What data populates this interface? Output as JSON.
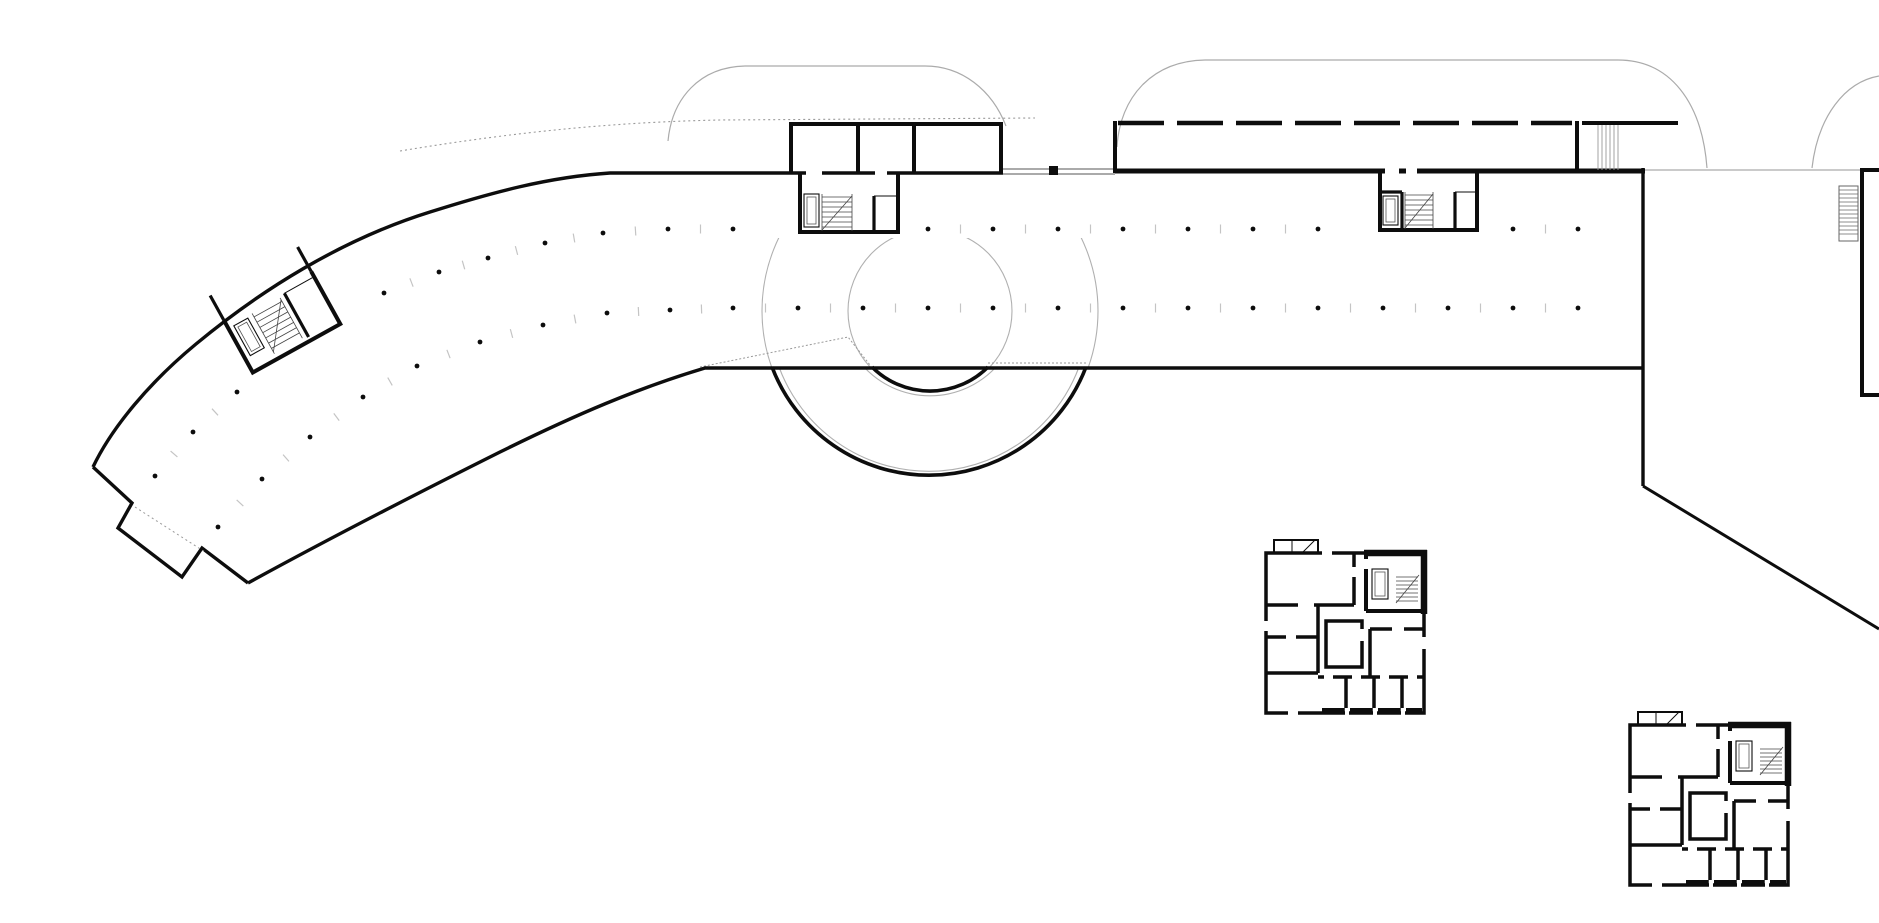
{
  "meta": {
    "drawing": "architectural-site-floor-plan",
    "description": "Line drawing: long curved slab building with parking columns, circular ramp, roof-canopy outlines, three stair cores and two detached square housing units",
    "background": "#ffffff",
    "ink": "#0d0d0d",
    "light_line": "#a6a6a6",
    "dotted_line": "#9a9a9a",
    "tick_color": "#c4c4c4"
  },
  "elements": [
    {
      "name": "curved-slab-building"
    },
    {
      "name": "left-stair-core"
    },
    {
      "name": "top-pavilion-block"
    },
    {
      "name": "pavilion-stair-core"
    },
    {
      "name": "dashed-roof-building"
    },
    {
      "name": "right-stair-core"
    },
    {
      "name": "circular-ramp"
    },
    {
      "name": "roof-canopy-outlines"
    },
    {
      "name": "far-right-room-with-ladder"
    },
    {
      "name": "site-boundary-diagonal"
    },
    {
      "name": "housing-unit-a"
    },
    {
      "name": "housing-unit-b"
    }
  ],
  "diagram": {
    "columns": {
      "dot_radius": 2.4,
      "tick_len": 9,
      "max_gap_for_tick": 80,
      "upper_row": [
        [
          1578,
          229
        ],
        [
          1513,
          229
        ],
        [
          1318,
          229
        ],
        [
          1253,
          229
        ],
        [
          1188,
          229
        ],
        [
          1123,
          229
        ],
        [
          1058,
          229
        ],
        [
          993,
          229
        ],
        [
          928,
          229
        ],
        [
          733,
          229
        ],
        [
          668,
          229
        ],
        [
          603,
          233
        ],
        [
          545,
          243
        ],
        [
          488,
          258
        ],
        [
          439,
          272
        ],
        [
          384,
          293
        ],
        [
          237,
          392
        ],
        [
          193,
          432
        ],
        [
          155,
          476
        ]
      ],
      "lower_row": [
        [
          1578,
          308
        ],
        [
          1513,
          308
        ],
        [
          1448,
          308
        ],
        [
          1383,
          308
        ],
        [
          1318,
          308
        ],
        [
          1253,
          308
        ],
        [
          1188,
          308
        ],
        [
          1123,
          308
        ],
        [
          1058,
          308
        ],
        [
          993,
          308
        ],
        [
          928,
          308
        ],
        [
          863,
          308
        ],
        [
          798,
          308
        ],
        [
          733,
          308
        ],
        [
          670,
          310
        ],
        [
          607,
          313
        ],
        [
          543,
          325
        ],
        [
          480,
          342
        ],
        [
          417,
          366
        ],
        [
          363,
          397
        ],
        [
          310,
          437
        ],
        [
          262,
          479
        ],
        [
          218,
          527
        ]
      ]
    },
    "ramp": {
      "cx": 930,
      "cy": 311,
      "r_outer": 168,
      "r_outer_thin": 160,
      "r_inner": 82,
      "r_inner_thin": 90
    }
  }
}
